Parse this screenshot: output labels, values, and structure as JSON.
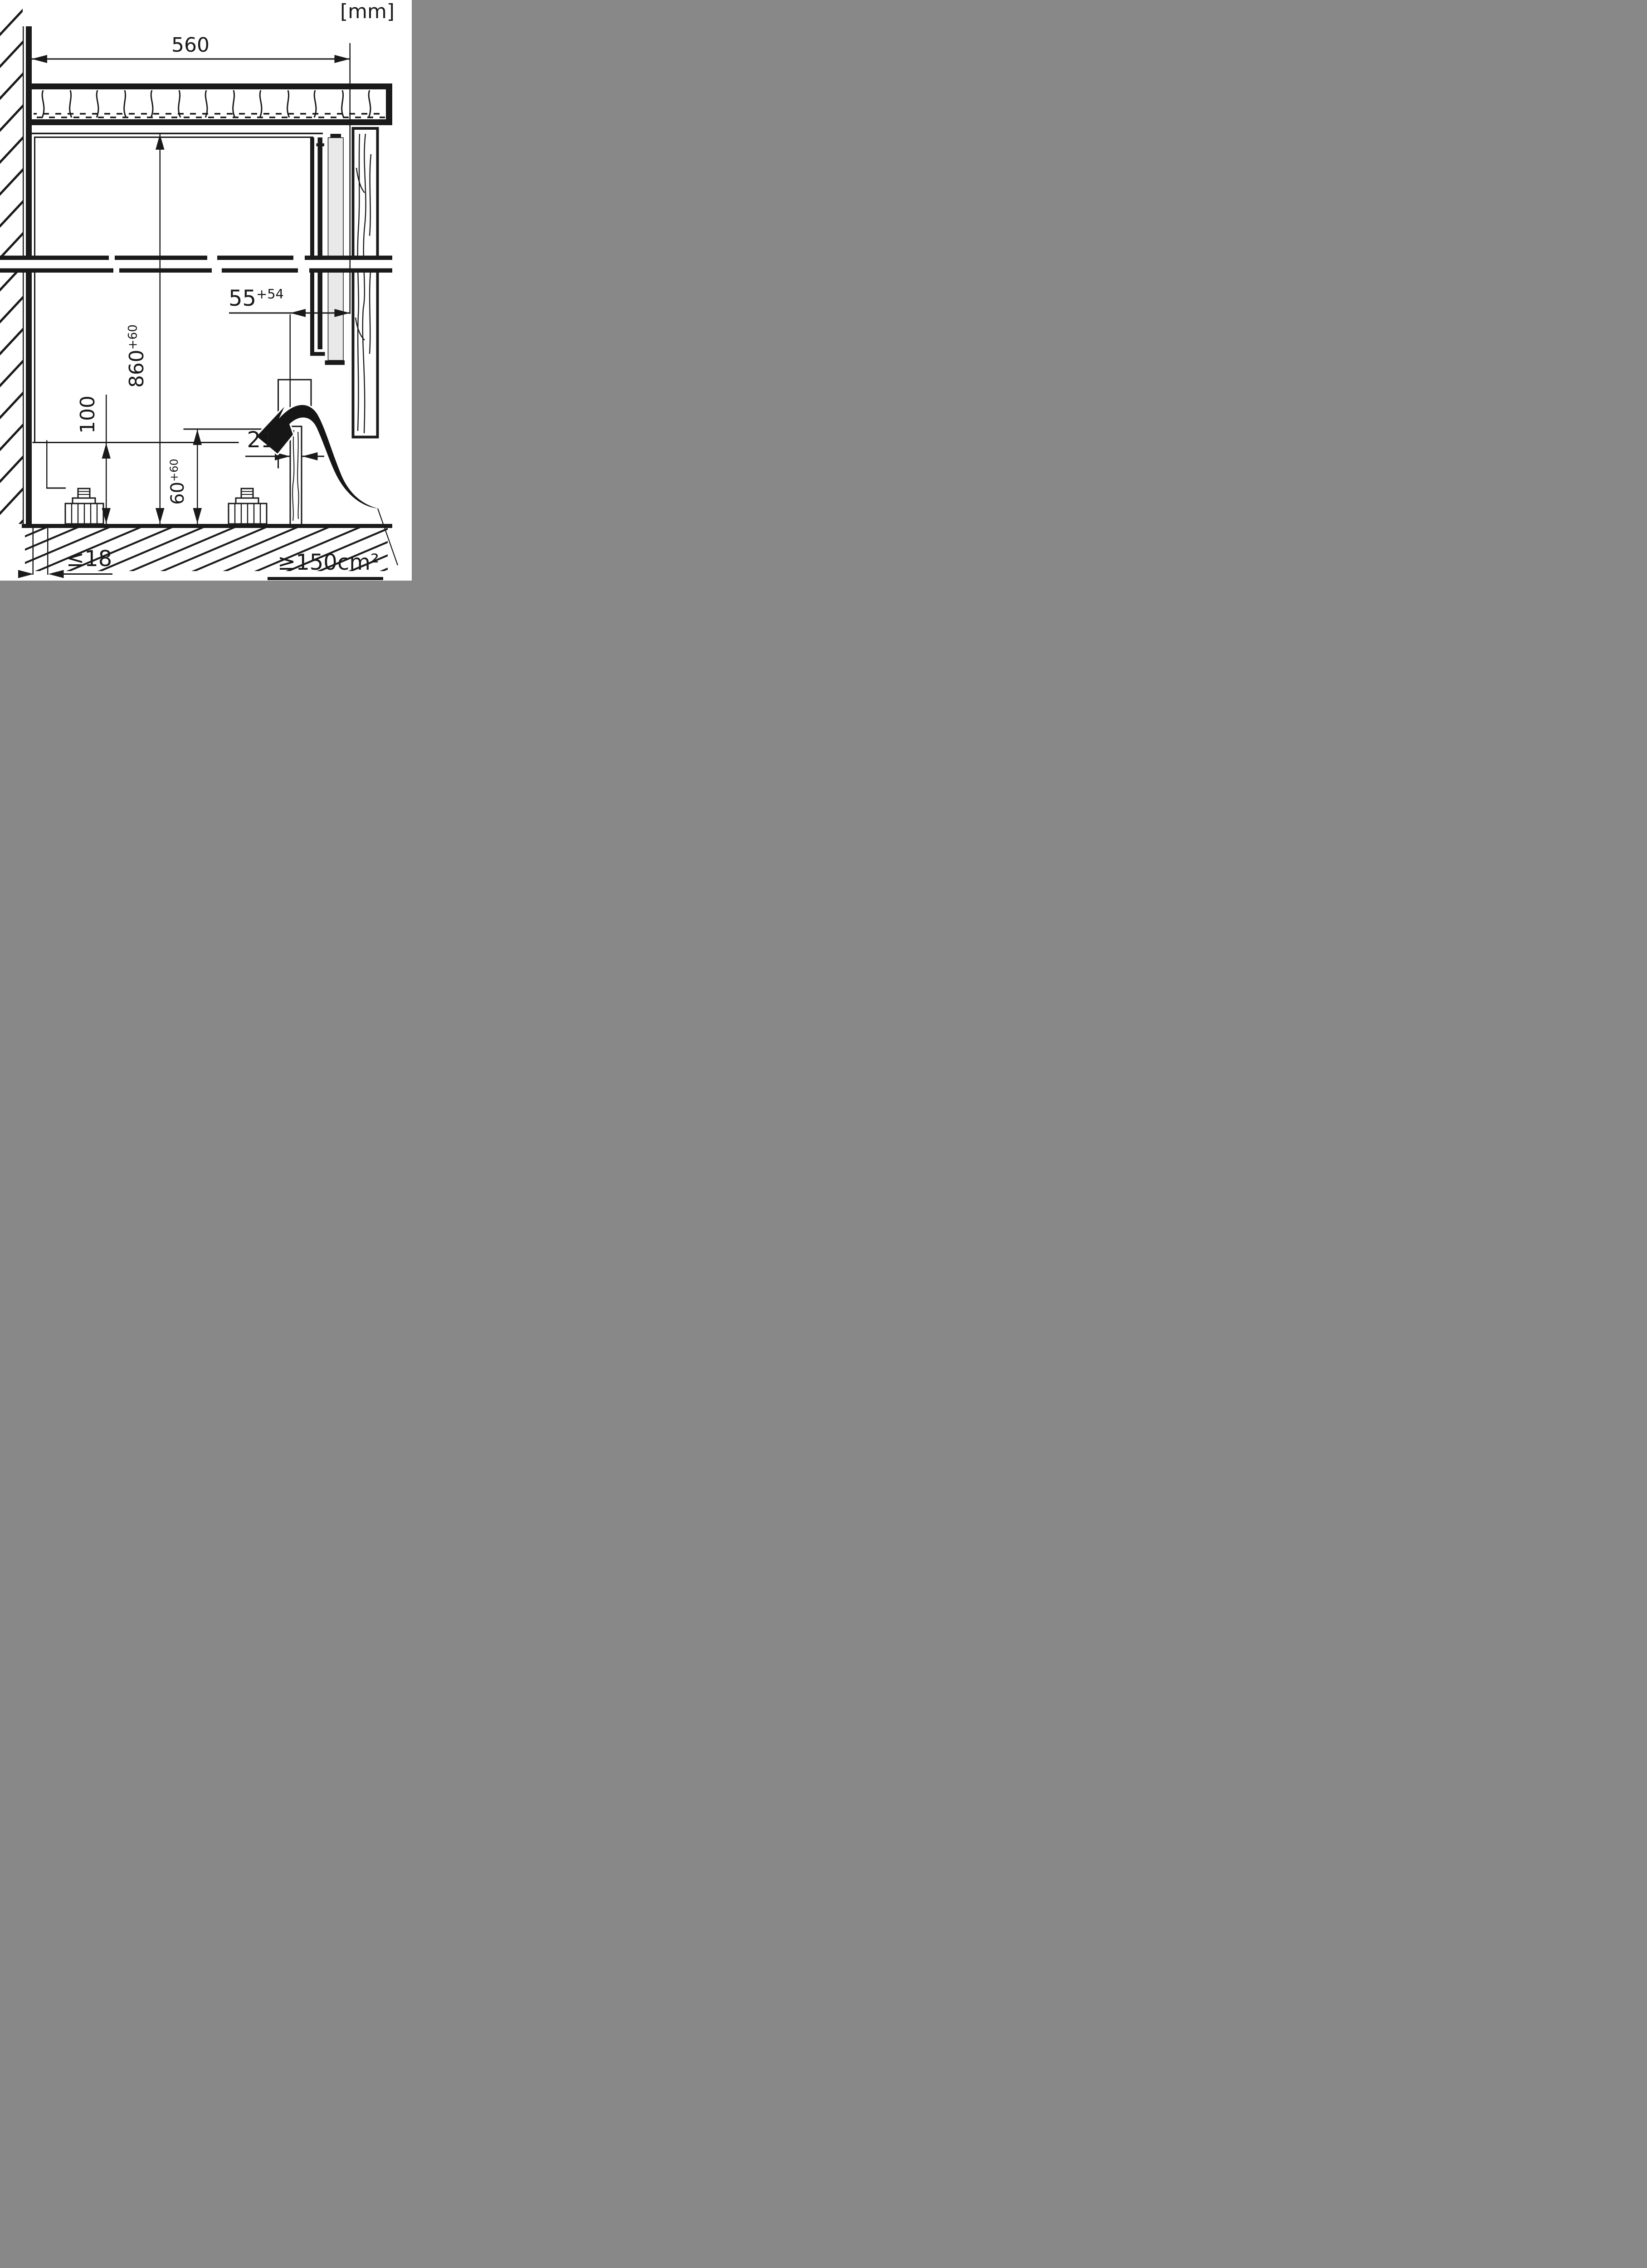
{
  "meta": {
    "unit": "[mm]"
  },
  "colors": {
    "ink": "#1a1a1a",
    "paper": "#ffffff",
    "door_strip_gray": "#e9e9e9"
  },
  "dims": {
    "niche_width": {
      "value": "560"
    },
    "niche_height": {
      "value": "860",
      "tol": "+60"
    },
    "front_gap": {
      "value": "55",
      "tol": "+54"
    },
    "floor_clearance": {
      "value": "100"
    },
    "plinth_height": {
      "value": "60",
      "tol": "+60"
    },
    "furniture_door_thickness": {
      "value": "21"
    },
    "plinth_recess_max": {
      "value": "≤18"
    },
    "vent_cross_section_min": {
      "value": "≥150cm²"
    }
  }
}
